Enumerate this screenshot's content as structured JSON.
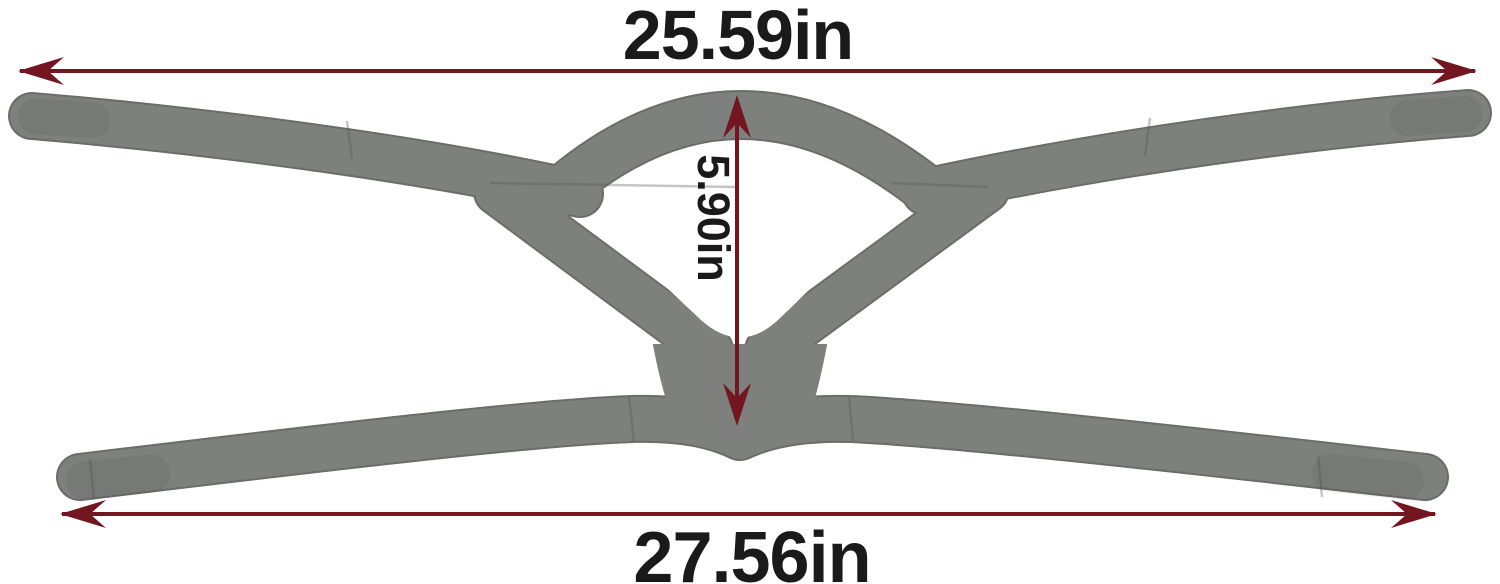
{
  "annotations": {
    "top_width_label": "25.59in",
    "inner_height_label": "5.90in",
    "bottom_width_label": "27.56in"
  },
  "colors": {
    "background": "#ffffff",
    "strap": "#7d807d",
    "strap_edge": "#6a6d6a",
    "strap_seam": "#565956",
    "arrow": "#741620",
    "label_text": "#1a1a1a"
  }
}
